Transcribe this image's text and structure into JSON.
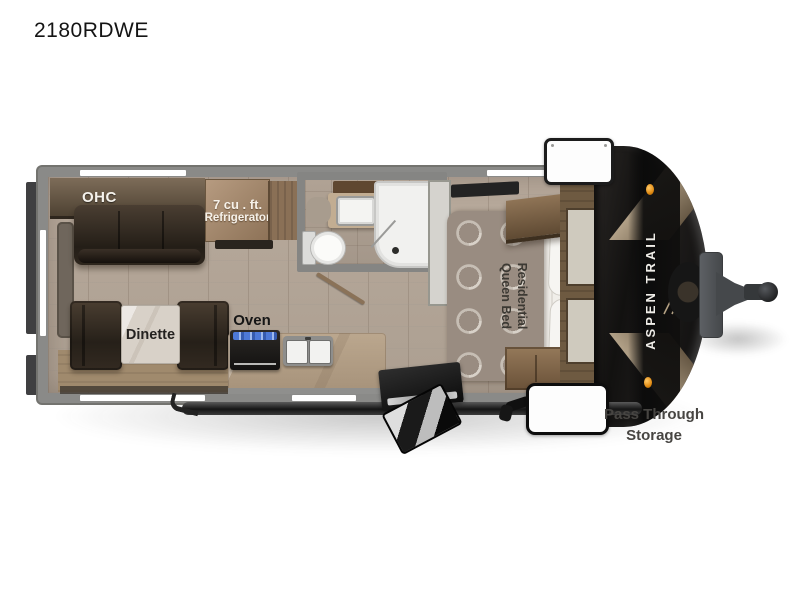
{
  "page": {
    "title": "2180RDWE"
  },
  "floorplan": {
    "labels": {
      "ohc": "OHC",
      "fridge_line1": "7 cu . ft.",
      "fridge_line2": "Refrigerator",
      "oven": "Oven",
      "dinette": "Dinette",
      "bed_line1": "Residential",
      "bed_line2": "Queen Bed",
      "brand": "ASPEN TRAIL",
      "storage_line1": "Pass Through",
      "storage_line2": "Storage"
    },
    "icons": {
      "brand_logo": "mountain-peaks",
      "marker_light": "amber-clearance-light"
    },
    "colors": {
      "wall_gray": "#8a8a88",
      "floor_tile": "#b3a396",
      "furniture_espresso": "#30281f",
      "cabinet_wood": "#8a6f52",
      "front_cap_black": "#141211",
      "marker_amber": "#e08a12",
      "label_text": "#242220"
    }
  }
}
